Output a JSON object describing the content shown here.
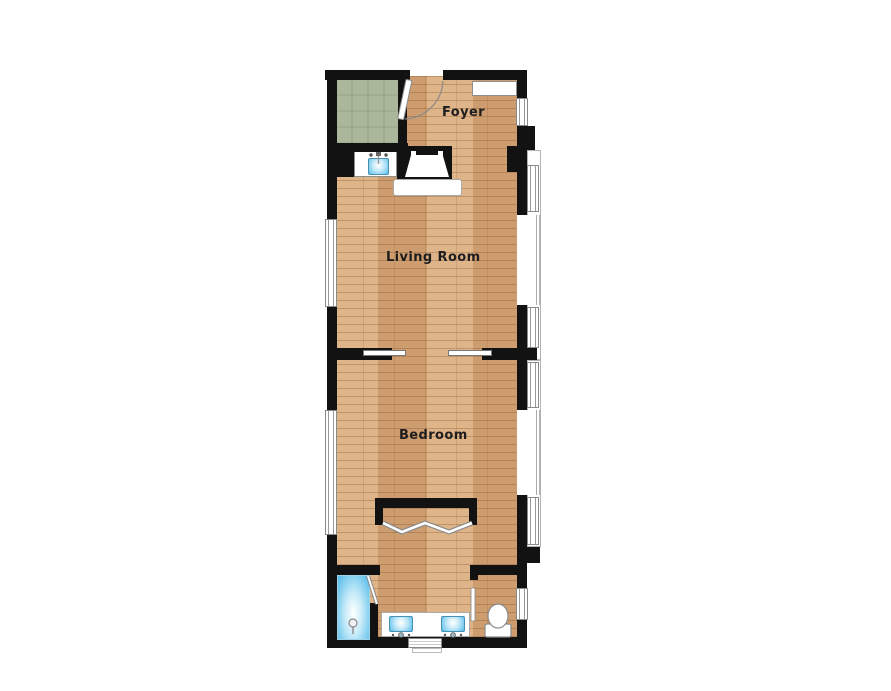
{
  "rooms": {
    "foyer": {
      "label": "Foyer"
    },
    "living_room": {
      "label": "Living Room"
    },
    "bedroom": {
      "label": "Bedroom"
    }
  },
  "fixtures": [
    "entry-door-with-swing",
    "carpeted-closet-room",
    "coat-closet",
    "wet-bar-sink",
    "fireplace-with-hearth",
    "pocket-double-doors",
    "bifold-closet-doors",
    "shower-with-glass-door",
    "double-vanity-sinks",
    "toilet",
    "bay-windows",
    "wall-windows"
  ],
  "colors": {
    "background": "#ffffff",
    "wall": "#121212",
    "wood_base": "#d7a87a",
    "carpet": "#aab79b",
    "fixture_blue": "#57bde9",
    "outline_gray": "#8f8f8f",
    "label": "#1e1e1e"
  }
}
